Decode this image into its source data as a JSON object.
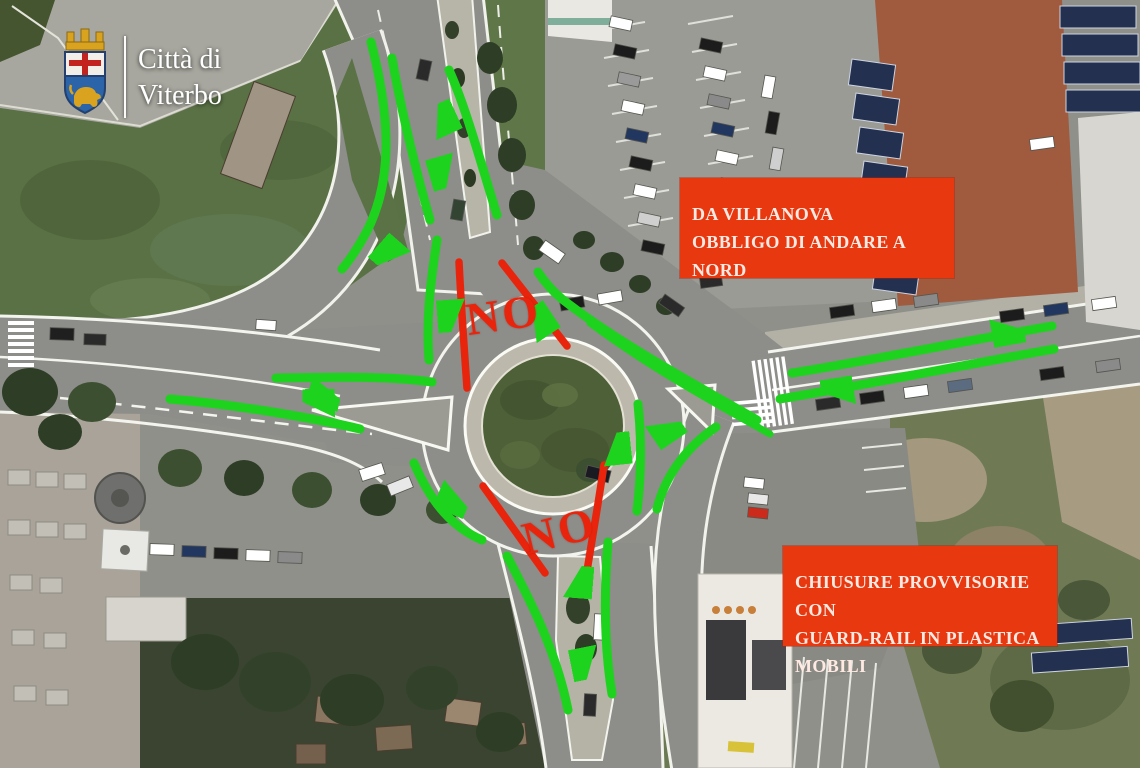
{
  "watermark": {
    "line1": "Città di",
    "line2": "Viterbo"
  },
  "callouts": {
    "villanova": {
      "lines": [
        "DA VILLANOVA",
        "OBBLIGO DI ANDARE A NORD"
      ]
    },
    "chiusure": {
      "lines": [
        "CHIUSURE PROVVISORIE CON",
        "GUARD-RAIL IN PLASTICA",
        "MOBILI"
      ]
    }
  },
  "closures": {
    "no_top": "NO",
    "no_bottom": "NO"
  },
  "colors": {
    "callout_red": "#e8380f",
    "closure_red": "#e8250c",
    "arrow_green": "#1ed31e",
    "island_grass": "#4e6038",
    "asphalt": "#8d8d89"
  },
  "flows": [
    "north-approach-entering-roundabout",
    "roundabout-exit-to-north",
    "north-road-curve-to-southwest-branch",
    "circulation-down-west-side",
    "circulation-bottom-left-toward-south-exit",
    "exit-to-west-road",
    "west-road-entering-roundabout",
    "circulation-up-east-side",
    "exit-to-east-road",
    "east-road-entering-roundabout",
    "exit-east-long-arrow",
    "from-villanova-mandatory-north-curve",
    "south-exit-arrow",
    "south-approach-entering"
  ]
}
